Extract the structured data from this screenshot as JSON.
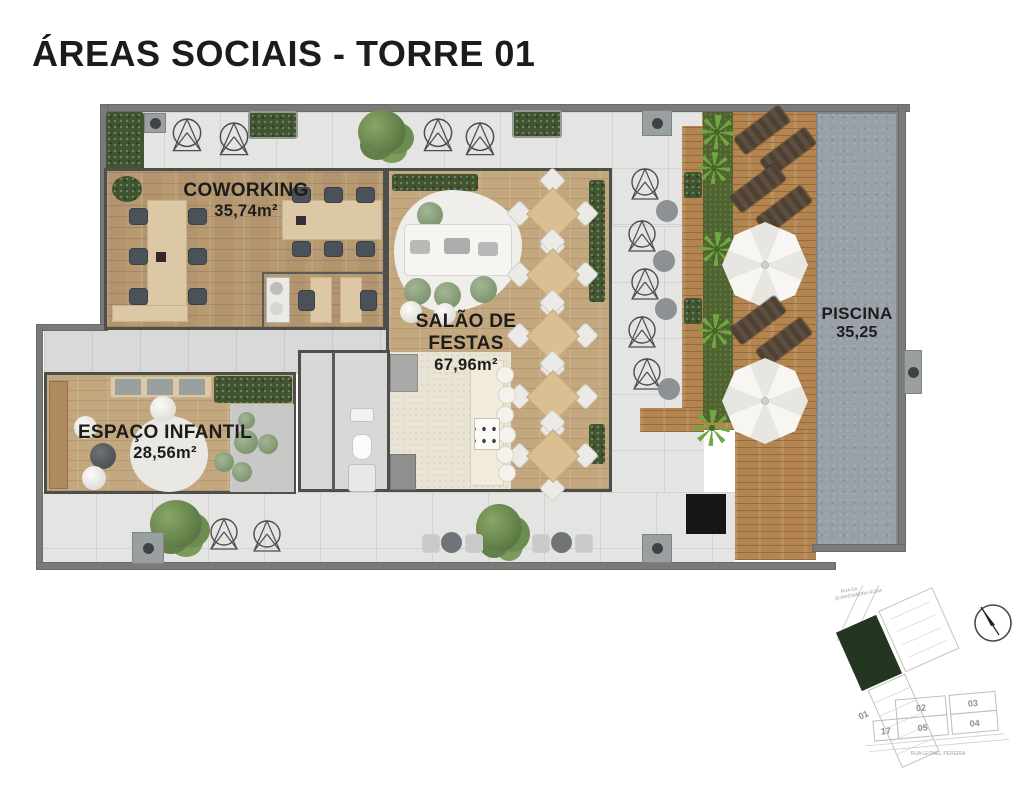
{
  "title": "ÁREAS SOCIAIS - TORRE 01",
  "rooms": {
    "coworking": {
      "name": "COWORKING",
      "area": "35,74m²"
    },
    "salao": {
      "name": "SALÃO DE FESTAS",
      "area": "67,96m²"
    },
    "infantil": {
      "name": "ESPAÇO INFANTIL",
      "area": "28,56m²"
    },
    "piscina": {
      "name": "PISCINA",
      "area": "35,25"
    }
  },
  "site_plan": {
    "street_top_line1": "RUA DA",
    "street_top_line2": "QUARESMEIRA ROXA",
    "street_bottom": "RUA LEONEL PEREIRA",
    "units": {
      "u01": "01",
      "u02": "02",
      "u03": "03",
      "u17": "17",
      "u05": "05",
      "u04": "04"
    },
    "compass_icon": "north-arrow"
  },
  "colors": {
    "title_text": "#1c1c1c",
    "terrace_tile": "#e4e4e2",
    "room_wood": "#bfa27a",
    "deck_wood": "#b5854f",
    "pool_gray": "#99a0a7",
    "hedge_green": "#40552f",
    "site_building_green": "#233620"
  }
}
